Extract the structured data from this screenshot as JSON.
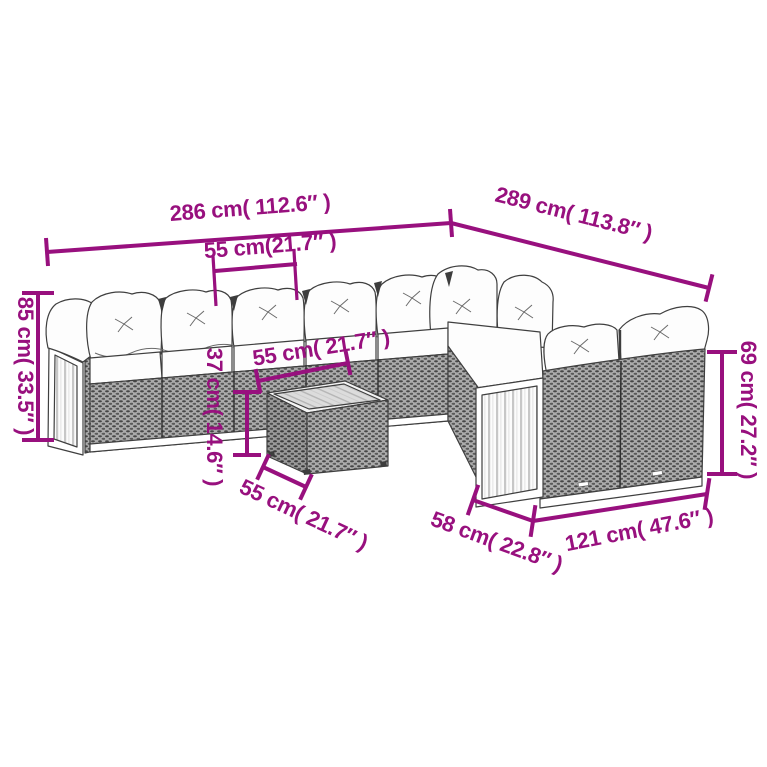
{
  "diagram": {
    "title": "rattan-lounge-set-dimension-diagram",
    "accent_color": "#98107E",
    "line_art_color": "#3F3F3F",
    "background_color": "#FFFFFF",
    "dims": {
      "back_left_width": {
        "label": "286 cm( 112.6″ )"
      },
      "back_right_width": {
        "label": "289 cm( 113.8″ )"
      },
      "seat_module_width": {
        "label": "55 cm(21.7″ )"
      },
      "left_height": {
        "label": "85 cm( 33.5″ )"
      },
      "table_top_width": {
        "label": "55 cm( 21.7″ )"
      },
      "table_height": {
        "label": "37 cm( 14.6″ )"
      },
      "table_depth": {
        "label": "55 cm( 21.7″ )"
      },
      "right_section_depth": {
        "label": "58 cm( 22.8″ )"
      },
      "right_section_width": {
        "label": "121 cm( 47.6″ )"
      },
      "right_height": {
        "label": "69 cm( 27.2″ )"
      }
    }
  }
}
